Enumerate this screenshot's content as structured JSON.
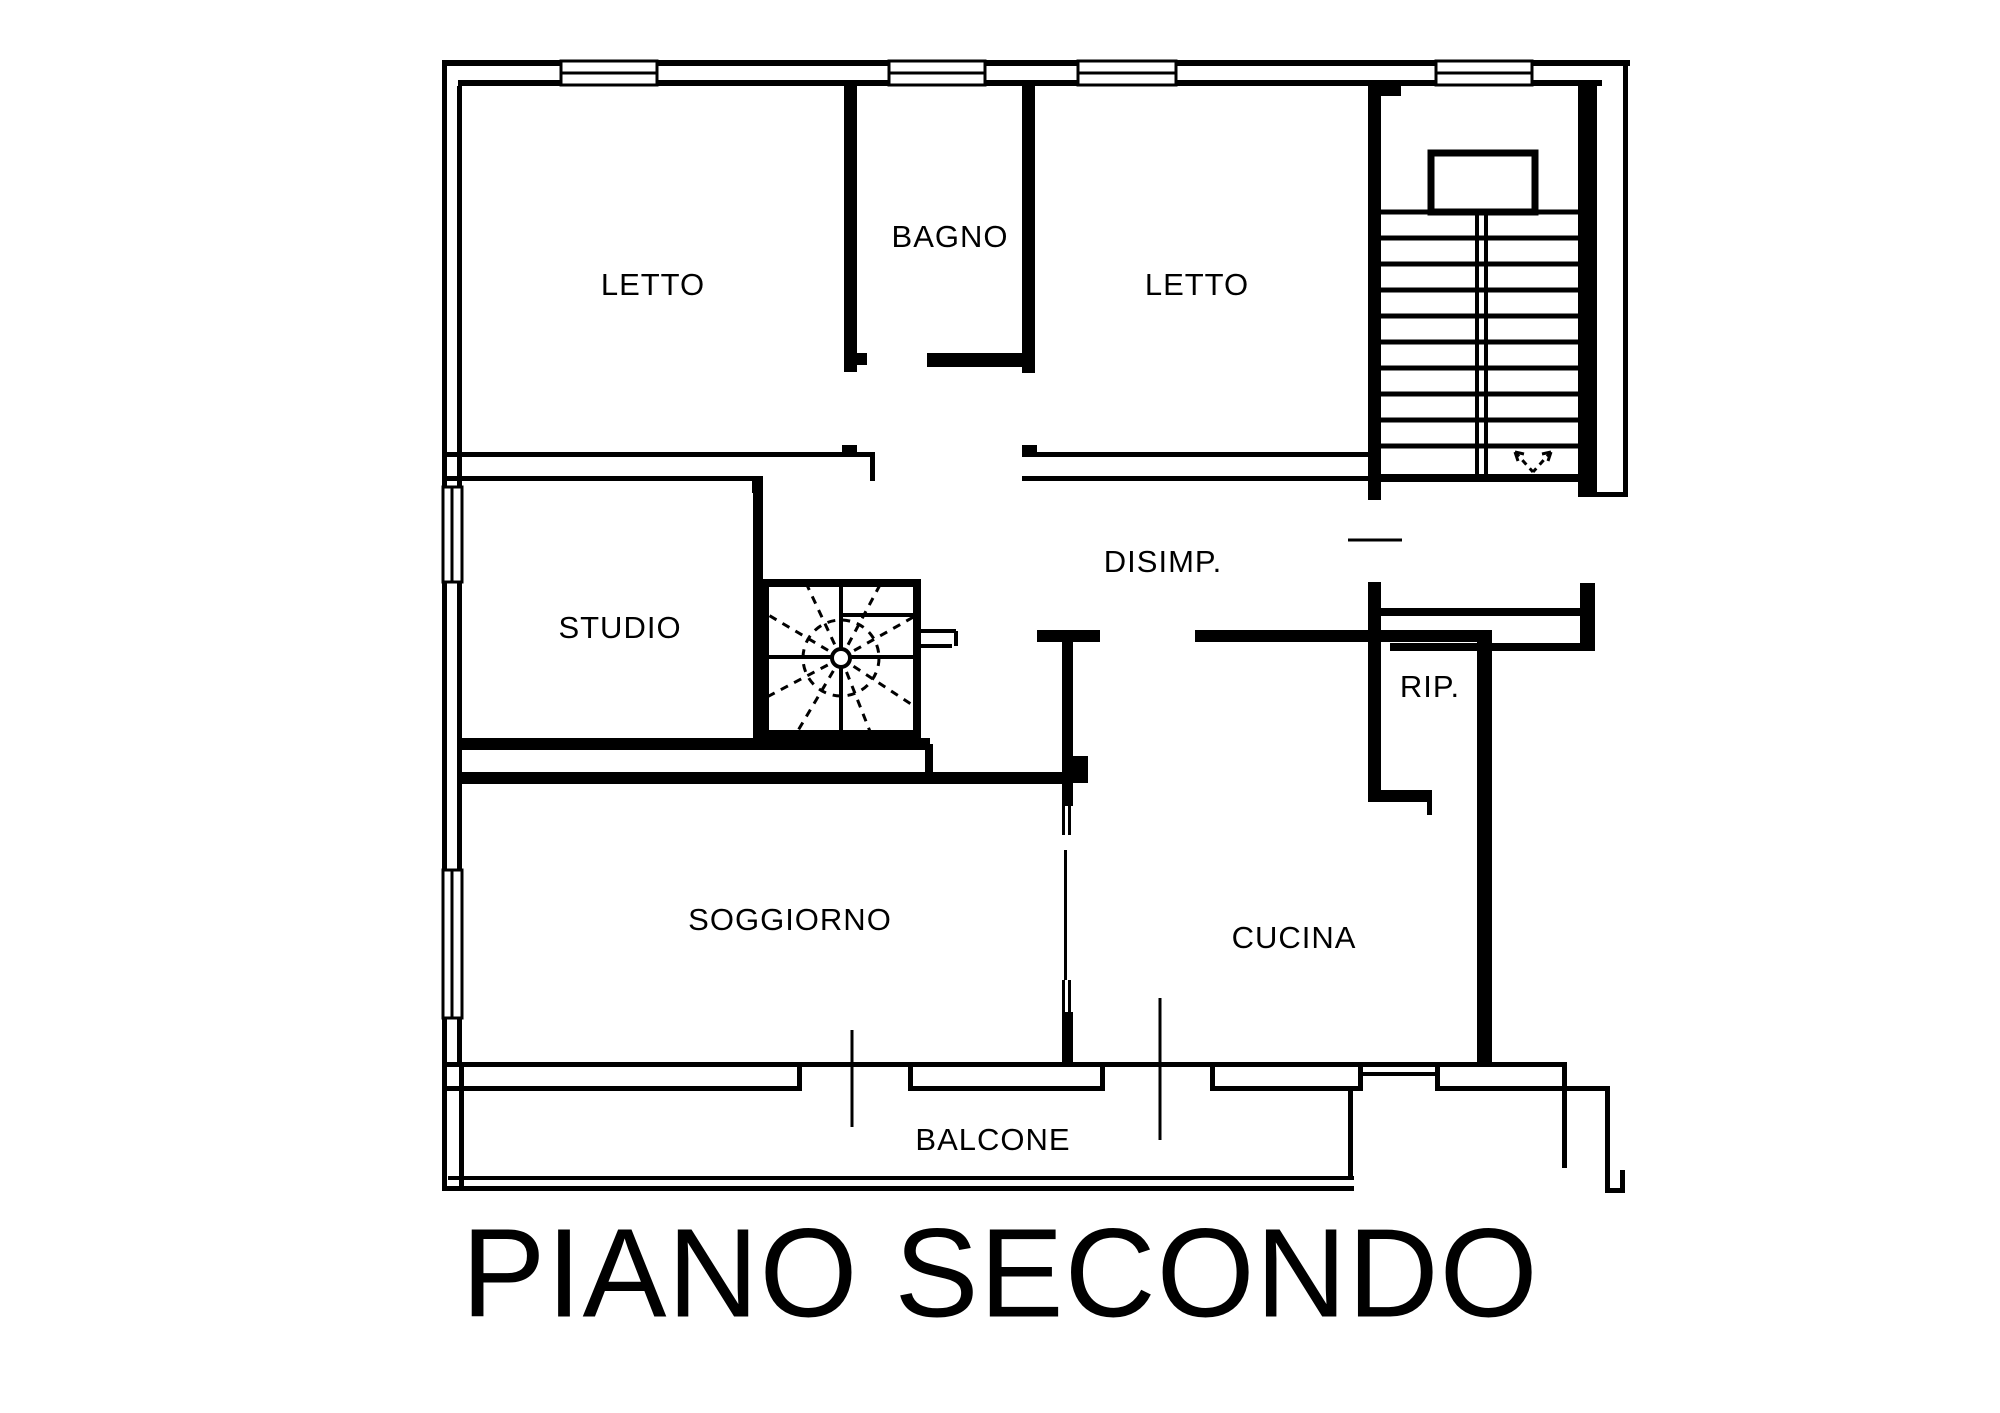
{
  "title": {
    "text": "PIANO SECONDO"
  },
  "rooms": [
    {
      "id": "letto-1",
      "label": "LETTO"
    },
    {
      "id": "bagno",
      "label": "BAGNO"
    },
    {
      "id": "letto-2",
      "label": "LETTO"
    },
    {
      "id": "studio",
      "label": "STUDIO"
    },
    {
      "id": "disimpegno",
      "label": "DISIMP."
    },
    {
      "id": "ripostiglio",
      "label": "RIP."
    },
    {
      "id": "soggiorno",
      "label": "SOGGIORNO"
    },
    {
      "id": "cucina",
      "label": "CUCINA"
    },
    {
      "id": "balcone",
      "label": "BALCONE"
    }
  ],
  "icons": {
    "stair_direction": "down-arrow",
    "spiral_staircase": "spiral-stair-symbol"
  },
  "colors": {
    "line": "#000000",
    "background": "#ffffff"
  }
}
